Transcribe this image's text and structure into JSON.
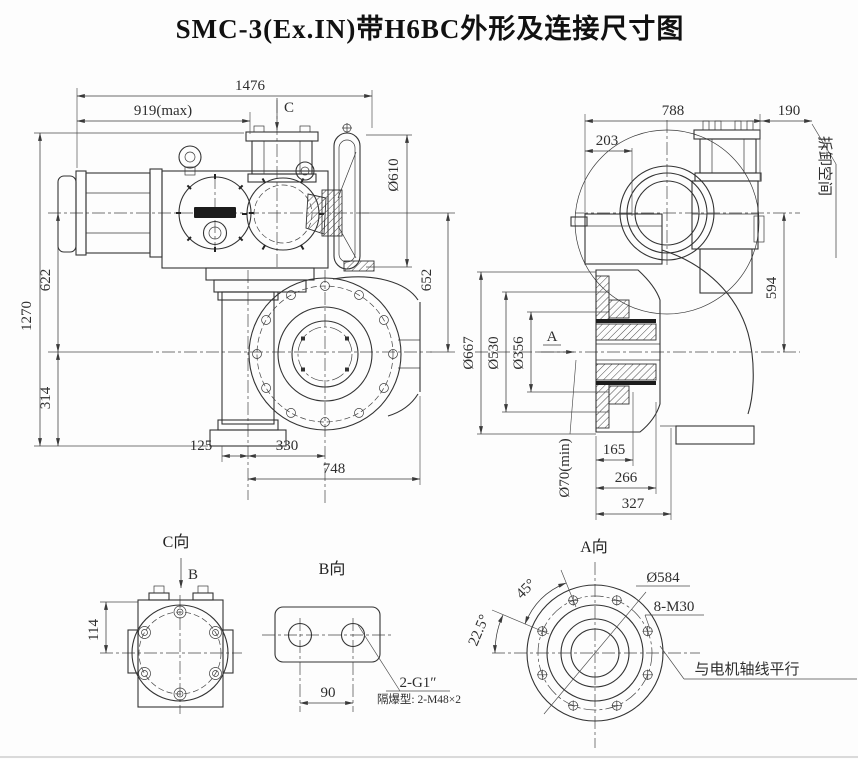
{
  "title": "SMC-3(Ex.IN)带H6BC外形及连接尺寸图",
  "colors": {
    "line": "#333333",
    "background": "#fdfdfd",
    "badge": "#1c1c1c"
  },
  "front_view": {
    "dims": {
      "overall_length": "1476",
      "motor_extent_max": "919(max)",
      "section_c_arrow": "C",
      "handwheel_dia": "Ø610",
      "handwheel_axis_to_output": "652",
      "overall_height": "1270",
      "motor_axis_to_output": "622",
      "output_axis_to_base": "314",
      "stem_offset": "125",
      "stem_to_flange_center": "330",
      "flange_depth": "748"
    }
  },
  "side_view": {
    "dims": {
      "overall_depth": "788",
      "removal_clearance": "190",
      "removal_clearance_note": "拆卸空间",
      "cover_depth": "203",
      "axis_distance": "594",
      "flange_od": "Ø667",
      "spigot_dia": "Ø530",
      "pilot_dia": "Ø356",
      "section_a_arrow": "A",
      "stem_bore": "Ø70(min)",
      "hub_len_1": "165",
      "hub_len_2": "266",
      "hub_len_3": "327"
    }
  },
  "view_c": {
    "label": "C向",
    "section_b_arrow": "B",
    "dim_height": "114"
  },
  "view_b": {
    "label": "B向",
    "hole_pitch": "90",
    "conduit_spec": "2-G1″",
    "conduit_note": "隔爆型: 2-M48×2"
  },
  "view_a": {
    "label": "A向",
    "bolt_angle": "45°",
    "bolt_offset_angle": "22.5°",
    "bolt_circle_dia": "Ø584",
    "bolt_spec": "8-M30",
    "alignment_note": "与电机轴线平行"
  }
}
